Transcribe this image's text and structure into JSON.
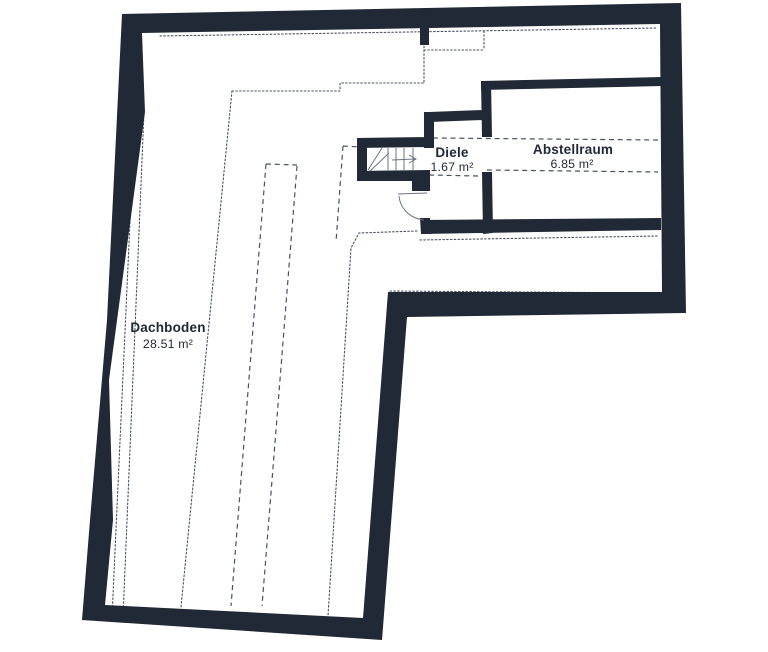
{
  "floorplan": {
    "title": "Attic floor plan",
    "rooms": [
      {
        "name": "Dachboden",
        "area": "28.51 m²"
      },
      {
        "name": "Diele",
        "area": "1.67 m²"
      },
      {
        "name": "Abstellraum",
        "area": "6.85 m²"
      }
    ],
    "colors": {
      "background": "#ffffff",
      "wall": "#212936",
      "guide_lines": "#4a515f",
      "symbol_lines": "#6a7380",
      "label": "#212936"
    },
    "symbols": [
      {
        "name": "staircase-with-winders"
      },
      {
        "name": "stair-direction-arrow"
      },
      {
        "name": "door-swing"
      }
    ]
  }
}
